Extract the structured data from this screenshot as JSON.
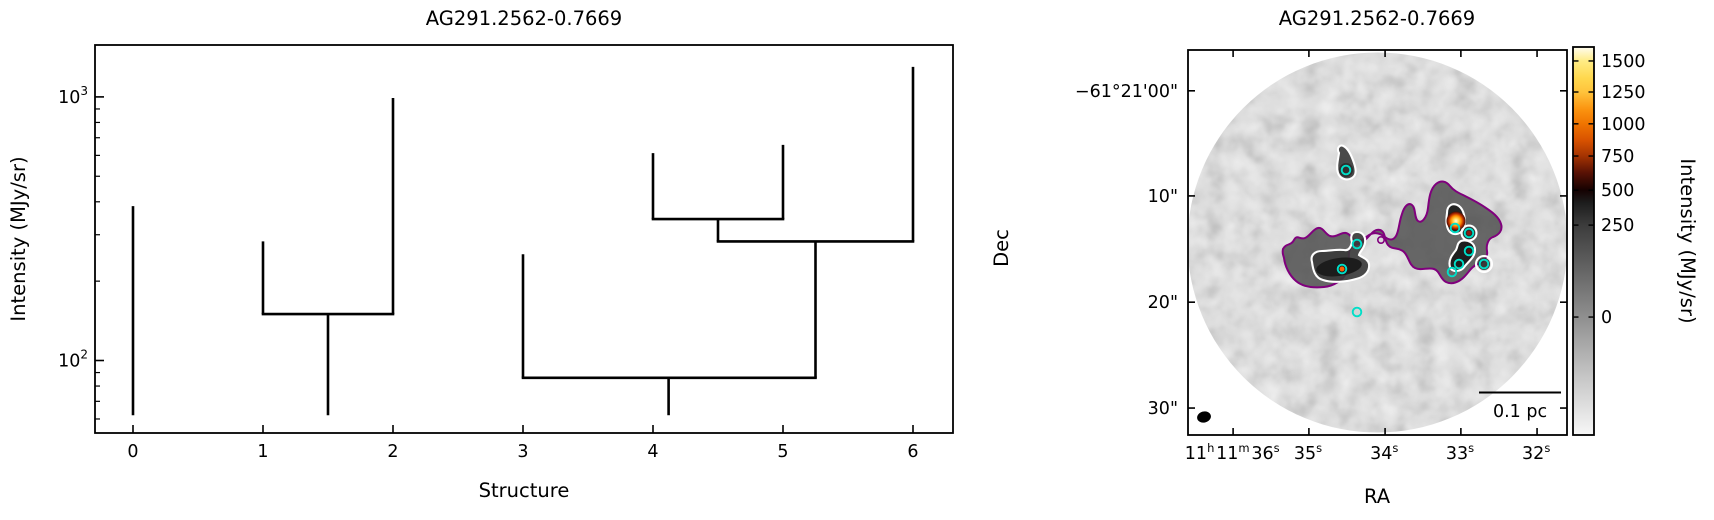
{
  "figure": {
    "width": 1714,
    "height": 520,
    "background": "#ffffff"
  },
  "left_panel": {
    "title": "AG291.2562-0.7669",
    "xlabel": "Structure",
    "ylabel": "Intensity (MJy/sr)",
    "x_ticks": [
      0,
      1,
      2,
      3,
      4,
      5,
      6
    ],
    "y_major_ticks": [
      {
        "value": 100,
        "base": "10",
        "exp": "2"
      },
      {
        "value": 1000,
        "base": "10",
        "exp": "3"
      }
    ],
    "y_minor_ticks": [
      60,
      70,
      80,
      90,
      200,
      300,
      400,
      500,
      600,
      700,
      800,
      900
    ],
    "x_range": [
      -0.29,
      6.31
    ],
    "y_range": [
      53,
      1570
    ],
    "y_scale": "log",
    "chart_data": {
      "type": "dendrogram",
      "xlabel": "Structure",
      "ylabel": "Intensity (MJy/sr)",
      "line_color": "#000000",
      "leaves": [
        {
          "structure": 0,
          "x": 0,
          "base": 62,
          "top": 385
        },
        {
          "structure": 1,
          "x": 1,
          "base": 150,
          "top": 283
        },
        {
          "structure": 2,
          "x": 2,
          "base": 150,
          "top": 990
        },
        {
          "structure": 3,
          "x": 3,
          "base": 86,
          "top": 253
        },
        {
          "structure": 4,
          "x": 4,
          "base": 344,
          "top": 612
        },
        {
          "structure": 5,
          "x": 5,
          "base": 344,
          "top": 658
        },
        {
          "structure": 6,
          "x": 6,
          "base": 283,
          "top": 1300
        }
      ],
      "merges": [
        {
          "x1": 1,
          "x2": 2,
          "level": 150,
          "stem_x": 1.5,
          "stem_base": 62
        },
        {
          "x1": 4,
          "x2": 5,
          "level": 344,
          "stem_x": 4.5,
          "stem_base": 283
        },
        {
          "x1": 4.5,
          "x2": 6,
          "level": 283,
          "stem_x": 5.25,
          "stem_base": 86
        },
        {
          "x1": 3,
          "x2": 5.25,
          "level": 86,
          "stem_x": 4.12,
          "stem_base": 62
        }
      ]
    }
  },
  "right_panel": {
    "title": "AG291.2562-0.7669",
    "xlabel": "RA",
    "ylabel": "Dec",
    "scalebar_label": "0.1 pc",
    "ra_ticks": [
      {
        "parts": [
          [
            "11",
            "h"
          ],
          [
            "11",
            "m"
          ],
          [
            "36",
            "s"
          ]
        ],
        "frac": 0.119
      },
      {
        "parts": [
          [
            "35",
            "s"
          ]
        ],
        "frac": 0.319
      },
      {
        "parts": [
          [
            "34",
            "s"
          ]
        ],
        "frac": 0.52
      },
      {
        "parts": [
          [
            "33",
            "s"
          ]
        ],
        "frac": 0.72
      },
      {
        "parts": [
          [
            "32",
            "s"
          ]
        ],
        "frac": 0.921
      }
    ],
    "dec_ticks": [
      {
        "label": "−61°21'00\"",
        "frac": 0.106
      },
      {
        "label": "10\"",
        "frac": 0.379
      },
      {
        "label": "20\"",
        "frac": 0.655
      },
      {
        "label": "30\"",
        "frac": 0.93
      }
    ],
    "colorbar": {
      "label": "Intensity (MJy/sr)",
      "ticks": [
        {
          "value": "1500",
          "pos": 0.036
        },
        {
          "value": "1250",
          "pos": 0.116
        },
        {
          "value": "1000",
          "pos": 0.198
        },
        {
          "value": "750",
          "pos": 0.281
        },
        {
          "value": "500",
          "pos": 0.369
        },
        {
          "value": "250",
          "pos": 0.459
        },
        {
          "value": "0",
          "pos": 0.696
        }
      ],
      "gradient": [
        {
          "offset": 0.0,
          "color": "#fffdf0"
        },
        {
          "offset": 0.036,
          "color": "#ffec85"
        },
        {
          "offset": 0.08,
          "color": "#ffd84e"
        },
        {
          "offset": 0.116,
          "color": "#ffc33c"
        },
        {
          "offset": 0.16,
          "color": "#fb9410"
        },
        {
          "offset": 0.198,
          "color": "#f07400"
        },
        {
          "offset": 0.24,
          "color": "#d85200"
        },
        {
          "offset": 0.281,
          "color": "#a43302"
        },
        {
          "offset": 0.325,
          "color": "#571104"
        },
        {
          "offset": 0.369,
          "color": "#150202"
        },
        {
          "offset": 0.4,
          "color": "#1c1c1c"
        },
        {
          "offset": 0.459,
          "color": "#3c3c3c"
        },
        {
          "offset": 0.55,
          "color": "#5c5c5c"
        },
        {
          "offset": 0.696,
          "color": "#8f8f8f"
        },
        {
          "offset": 0.85,
          "color": "#c6c6c6"
        },
        {
          "offset": 1.0,
          "color": "#f7f7f7"
        }
      ]
    },
    "chart_data": {
      "type": "sky_image",
      "field_shape": "circle",
      "contour_colors": {
        "outer": "#80007d",
        "inner": "#ffffff"
      },
      "marker_color": "#00dfc8",
      "source_markers": [
        {
          "x": 1346,
          "y": 170
        },
        {
          "x": 1357,
          "y": 244
        },
        {
          "x": 1342,
          "y": 269
        },
        {
          "x": 1455,
          "y": 228
        },
        {
          "x": 1469,
          "y": 233
        },
        {
          "x": 1469,
          "y": 251
        },
        {
          "x": 1459,
          "y": 264
        },
        {
          "x": 1452,
          "y": 272
        },
        {
          "x": 1484,
          "y": 264
        },
        {
          "x": 1357,
          "y": 312
        }
      ],
      "inner_dots": [
        {
          "x": 1342,
          "y": 269,
          "r": 2.5,
          "color": "#ff5f00"
        },
        {
          "x": 1469,
          "y": 233,
          "r": 2.3,
          "color": "#8c1a10"
        },
        {
          "x": 1469,
          "y": 251,
          "r": 2.0,
          "color": "#5a0f08"
        }
      ],
      "bright_source": {
        "x": 1456,
        "y": 221,
        "r": 9.5
      },
      "purple_ring": {
        "x": 1381,
        "y": 240,
        "r": 3.2
      },
      "purple_path": "M1283,249 C1286,243 1291,246 1294,240 C1297,234 1300,240 1305,238 C1310,236 1313,229 1318,228 C1323,227 1325,234 1330,236 C1336,238 1341,232 1346,233 C1351,234 1352,240 1357,241 C1362,242 1366,236 1371,234 C1376,232 1381,234 1385,237 C1389,240 1393,241 1396,236 C1399,231 1399,222 1402,214 C1404,207 1408,202 1412,205 C1416,208 1414,218 1418,221 C1422,224 1427,217 1428,208 C1429,199 1430,189 1436,184 C1441,180 1446,181 1450,186 C1454,191 1459,193 1465,196 C1471,199 1479,203 1486,208 C1492,212 1499,217 1501,224 C1503,230 1499,235 1493,237 C1488,239 1486,245 1487,251 C1488,257 1484,262 1478,264 C1472,266 1469,272 1464,277 C1459,282 1452,285 1446,282 C1440,279 1440,271 1434,269 C1428,267 1421,271 1415,268 C1409,265 1409,257 1404,252 C1399,247 1392,250 1388,245 C1384,240 1386,232 1380,230 C1374,228 1370,236 1364,241 C1358,246 1353,243 1350,249 C1347,255 1351,264 1347,272 C1343,280 1334,286 1324,287 C1314,288 1303,287 1296,281 C1289,275 1285,266 1284,258 C1283,254 1282,253 1283,249 Z",
      "white_paths": [
        {
          "d": "M1339,153 C1336,148 1340,143 1345,147 C1349,150 1352,157 1354,163 C1356,169 1357,175 1352,178 C1347,181 1340,179 1338,173 C1336,167 1338,160 1339,153 Z",
          "fill": "#3a3a3a"
        },
        {
          "d": "M1312,262 C1310,255 1315,251 1322,251 C1330,251 1337,249 1344,250 C1349,251 1351,247 1352,242 C1350,236 1352,232 1357,232 C1363,232 1366,237 1365,243 C1364,249 1360,251 1359,255 C1363,258 1368,259 1369,264 C1370,271 1365,277 1356,279 C1346,282 1332,283 1323,280 C1315,278 1313,270 1312,262 Z",
          "fill": "#383838"
        },
        {
          "d": "M1447,213 C1447,205 1453,202 1459,206 C1464,210 1466,219 1464,227 C1462,234 1455,236 1450,232 C1446,228 1446,220 1447,213 Z",
          "fill": "#1d1d1d"
        },
        {
          "d": "M1461,241 C1468,239 1475,243 1475,250 C1475,257 1469,261 1465,266 C1461,272 1452,273 1450,267 C1448,260 1452,255 1456,250 C1458,246 1457,243 1461,241 Z",
          "fill": "#161616"
        }
      ],
      "white_rings": [
        {
          "x": 1469,
          "y": 233,
          "r": 7.5
        },
        {
          "x": 1484,
          "y": 264,
          "r": 8.0
        }
      ],
      "dark_blobs": [
        {
          "x": 1339,
          "y": 267,
          "rx": 23,
          "ry": 9,
          "rot": -8,
          "color": "#191919"
        },
        {
          "x": 1346,
          "y": 170,
          "rx": 7,
          "ry": 7,
          "rot": 0,
          "color": "#2e2e2e"
        },
        {
          "x": 1469,
          "y": 233,
          "rx": 6,
          "ry": 6,
          "rot": 0,
          "color": "#262626"
        },
        {
          "x": 1484,
          "y": 264,
          "rx": 6,
          "ry": 6,
          "rot": 0,
          "color": "#2b2b2b"
        }
      ]
    }
  }
}
